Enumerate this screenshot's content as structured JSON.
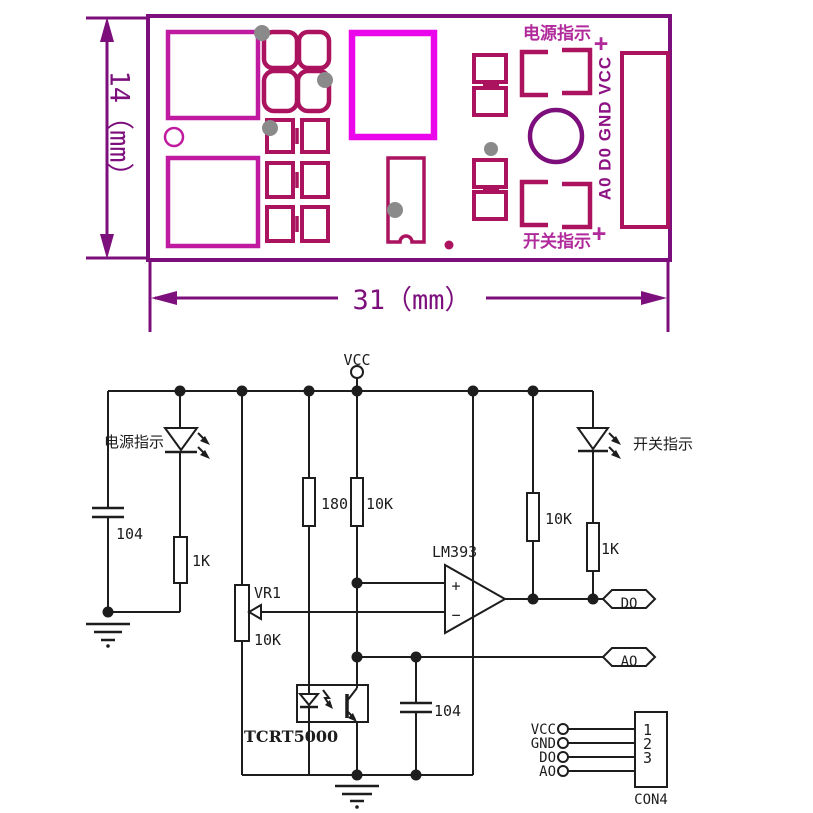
{
  "pcb": {
    "height_dim": "14（mm）",
    "width_dim": "31（mm）",
    "power_led_silk": "电源指示",
    "plus_top": "+",
    "switch_led_silk": "开关指示",
    "plus_bottom": "+",
    "pin_row": "A0 D0 GND VCC"
  },
  "schematic": {
    "vcc": "VCC",
    "power_led": "电源指示",
    "switch_led": "开关指示",
    "cap_left": "104",
    "res_led_left": "1K",
    "res_ir": "180",
    "res_pullup_mid": "10K",
    "vr_name": "VR1",
    "vr_value": "10K",
    "comparator": "LM393",
    "plus": "+",
    "minus": "−",
    "res_pullup_out": "10K",
    "res_led_right": "1K",
    "do_flag": "DO",
    "ao_flag": "AO",
    "cap_out": "104",
    "sensor": "TCRT5000",
    "conn": {
      "pin1_label": "VCC",
      "pin2_label": "GND",
      "pin3_label": "DO",
      "pin4_label": "AO",
      "num1": "1",
      "num2": "2",
      "num3": "3",
      "name": "CON4"
    }
  },
  "colors": {
    "pcb_outline": "#7c0f7c",
    "pcb_pad": "#c01ba0",
    "pcb_bright": "#ea05ea",
    "pcb_footprint": "#ab135f",
    "pcb_silk_text": "#b12a9b",
    "pcb_pin_text": "#8d1283",
    "schematic_ink": "#1d1d1d",
    "drill_gray": "#8a8a8a"
  }
}
